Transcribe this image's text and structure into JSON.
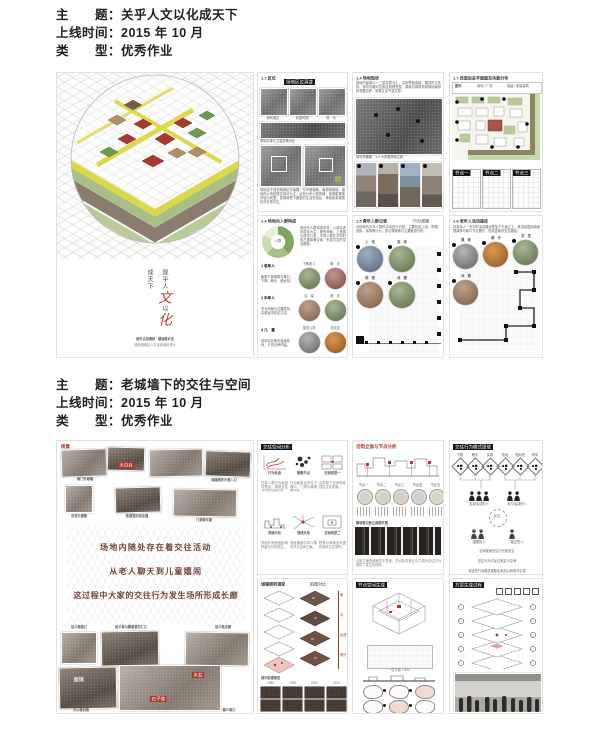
{
  "colors": {
    "accent_red": "#a8362c",
    "ink": "#1f1f1f",
    "poster_border": "#e3e1dd",
    "yellow": "#ddd94f",
    "green": "#6e9a50",
    "dark_red_text": "#74403a"
  },
  "header1": {
    "topic": "主　　题：关乎人文以化成天下",
    "time": "上线时间：2015 年 10 月",
    "type": "类　　型：优秀作业"
  },
  "header2": {
    "topic": "主　　题：老城墙下的交往与空间",
    "time": "上线时间：2015 年 10 月",
    "type": "类　　型：优秀作业"
  },
  "s1a": {
    "calli_pre": "观乎人",
    "calli_red1": "文",
    "calli_mid": "以",
    "calli_red2": "化",
    "calli_post": "成天下",
    "cap1": "城市认知调研 · 顺城巷片区",
    "cap2": "西安明城区人文化成城市设计"
  },
  "s1b1": {
    "tag": "1.1 区位",
    "title": "场地区位演变",
    "caps": [
      "明代城区",
      "民国时期",
      "现　代"
    ],
    "cap2": "场地沿革与卫星影像对比",
    "para": "场地位于西安明城区东南隅，东邻顺城巷，南倚明城墙。基地内以传统居住街坊为主，沿街分布小型商铺，街巷肌理保存较为完整，是城墙根下典型的生活性街区，承载着老城居民的日常记忆。"
  },
  "s1b2": {
    "tag": "1.4 场地内人群构成",
    "donut_label": "人群",
    "para": "场地内人群构成多样，以原住老年居民为主，兼有商贩、上班族与放学儿童，不同人群在不同时段占据街巷空间，形成丰富的生活图景。",
    "groups": [
      {
        "h": "1 老年人",
        "t": "聚集于城墙根与巷口，下棋、聊天、晒太阳。"
      },
      {
        "h": "2 中年人",
        "t": "多为商贩与过路居民，买菜途中驻足交谈。"
      },
      {
        "h": "3 儿　童",
        "t": "放学后在巷内追逐嬉戏，于花坛旁停留。"
      }
    ],
    "circles": [
      "下棋老人",
      "聊　天",
      "买　菜",
      "散　步",
      "接送儿童",
      "花坛边"
    ]
  },
  "s1c1": {
    "tag": "1.4 场地现状",
    "para": "场地内建筑以一二层民居为主，沿街界面连续，屋顶形式多样。现状鸟瞰可见街区肌理完整，城墙与绿带构成场地南侧的重要边界，街巷生活气息浓厚。",
    "img_cap": "场地鸟瞰图　1-4 为重要界面位置",
    "photos": [
      "临街商铺",
      "传统民居",
      "城墙界面",
      "巷道生活"
    ]
  },
  "s1c2": {
    "tag": "1.5 青年人群记录",
    "sub": "行为观察",
    "para": "对场地内青年人群的活动进行记录，主要包括上班、购物、逛街、休憩等行为，多沿顺城巷与主要巷道分布。",
    "circles": [
      "上　班",
      "逛　街",
      "购　物",
      "休　憩"
    ]
  },
  "s1d1": {
    "tag": "1.7 改造后总平面图及功能分布",
    "legend": [
      "图例",
      "绿地 / 广场",
      "保留 / 新建建筑"
    ],
    "subs": [
      "节点一",
      "节点二",
      "节点三"
    ]
  },
  "s1d2": {
    "tag": "1.8 老年人活动路径",
    "para": "将老年人一天中的活动路径叠加于平面之上，其活动围绕城墙根绿带与巷口节点展开，形成连续的交往路径。",
    "circles": [
      "晨　练",
      "聊　天",
      "买　菜",
      "休　憩"
    ]
  },
  "s2a": {
    "tag": "街景",
    "cap_a": "南门外城墙",
    "cap_b": "城墙根状元巷入口",
    "cap_c": "杂货示意摊",
    "cap_d": "巷道里的老店铺",
    "cap_e": "门洞修车铺",
    "label1": "太白豆",
    "mid": [
      "场地内随处存在着交往活动",
      "从老人聊天到儿童嬉闹",
      "这过程中大家的交往行为发生场所形成长廊"
    ],
    "cap_f": "信义巷路口",
    "cap_g": "信义巷与顺城巷交汇口",
    "cap_h": "信义巷店铺",
    "label2": "水盆",
    "label3": "石子馍",
    "sign": "面馆",
    "cap_i": "方心巷旧照",
    "cap_j": "顺义巷口"
  },
  "s2b1": {
    "title": "交往空间分析",
    "cells": [
      {
        "cap": "行为轨迹",
        "t": "记录人群行为轨迹并叠加，得到交往活动的高频区域。"
      },
      {
        "cap": "聚集节点",
        "t": "行为聚集点多位于巷口、门洞与城墙根空地。"
      },
      {
        "cap": "空间类型一",
        "t": "沿街檐下空间构成线性交往界面。"
      },
      {
        "cap": "界面分析",
        "t": "界面开敞程度影响停留行为的发生。"
      },
      {
        "cap": "视线关系",
        "t": "视线通廊引导人群向节点空间汇聚。"
      },
      {
        "cap": "空间类型二",
        "t": "院落与转角空地提供面状交往场所。"
      }
    ]
  },
  "s2b2": {
    "t1": "城墙层积演变",
    "t2": "肌理对比",
    "ticks": [
      "明",
      "清",
      "民国",
      "现代"
    ],
    "cap": "城市肌理演变",
    "years": [
      "1980",
      "1996",
      "2004",
      "2015"
    ]
  },
  "s2c1": {
    "tag": "沿街立面与节点分析",
    "circles": [
      "节点一",
      "节点二",
      "节点三",
      "节点四",
      "节点五"
    ],
    "cap": "顺城巷沿街立面展开图",
    "para": "沿街立面连续而富于变化，节点处的退让与门洞为交往行为提供了发生的场所。"
  },
  "s2c2": {
    "title": "节点空间生成",
    "cap": "一层平面 1:500"
  },
  "s2d1": {
    "title": "交往行为模式提取",
    "cells": [
      "下棋",
      "聊天",
      "买菜",
      "嬉戏",
      "晒太阳",
      "修车"
    ],
    "g1": "发起活动的人",
    "g2": "参与活动的人",
    "circle": "交往",
    "g3": "围观的人",
    "g4": "路过的人",
    "lines": [
      "空间促使交往行为的发生",
      "交往行为又反过来定义空间",
      "将这些行为模式提取出来加以利用与引导",
      "那么城墙下的门洞、巷口与空地",
      "将重新成为老城生活的交往长廊"
    ]
  },
  "s2d2": {
    "title": "方案生成过程"
  }
}
